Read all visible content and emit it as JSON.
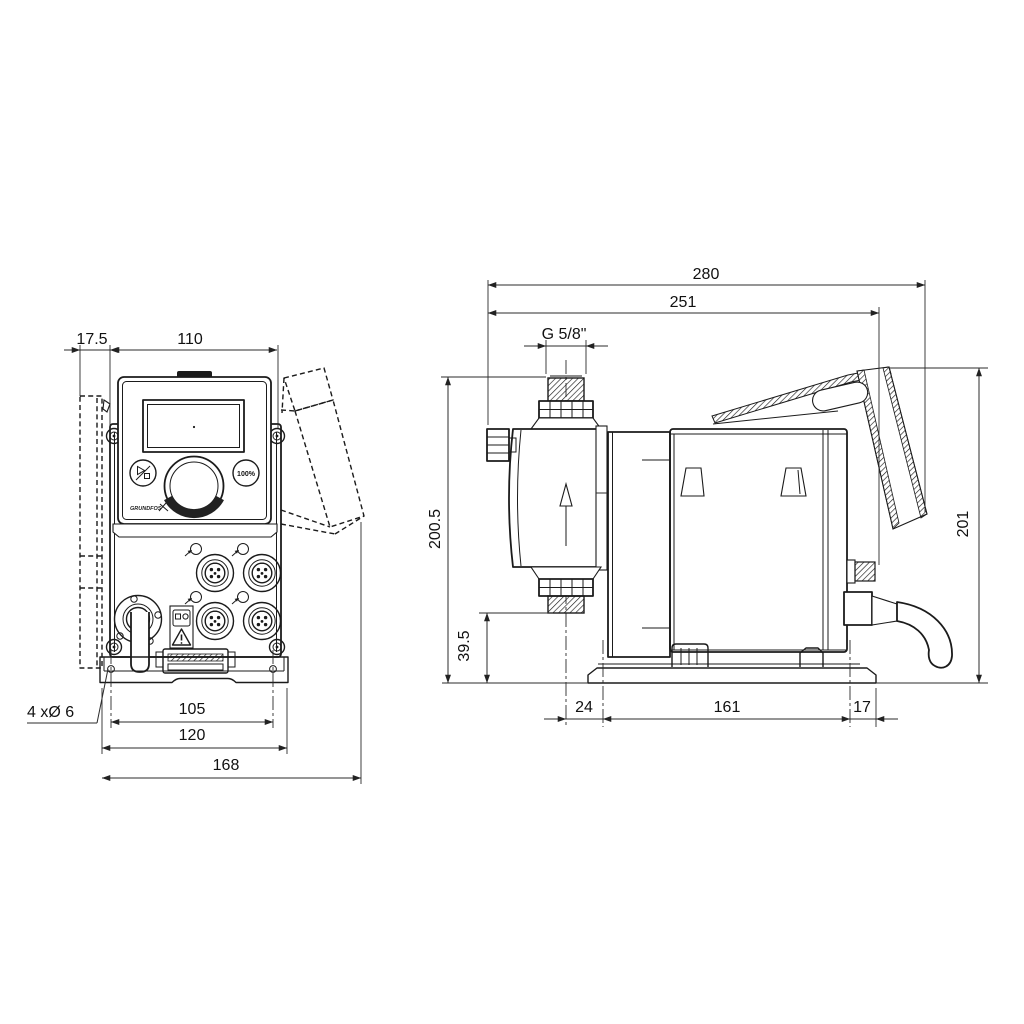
{
  "colors": {
    "line": "#1b1b1b",
    "background": "#ffffff"
  },
  "front_view": {
    "dim_bracket_offset": "17.5",
    "dim_housing_width": "110",
    "dim_hole_spacing": "105",
    "dim_plate_width": "120",
    "dim_overall_width": "168",
    "label_mounting_holes": "4 xØ 6",
    "button_capacity": "100%",
    "logo": "GRUNDFOS"
  },
  "side_view": {
    "dim_overall_depth": "280",
    "dim_depth_to_hood": "251",
    "label_connection_thread": "G 5/8\"",
    "dim_height_inlet": "200.5",
    "dim_outlet_height": "39.5",
    "dim_front_to_hole": "24",
    "dim_hole_spacing": "161",
    "dim_hole_to_rear": "17",
    "dim_overall_height": "201"
  }
}
